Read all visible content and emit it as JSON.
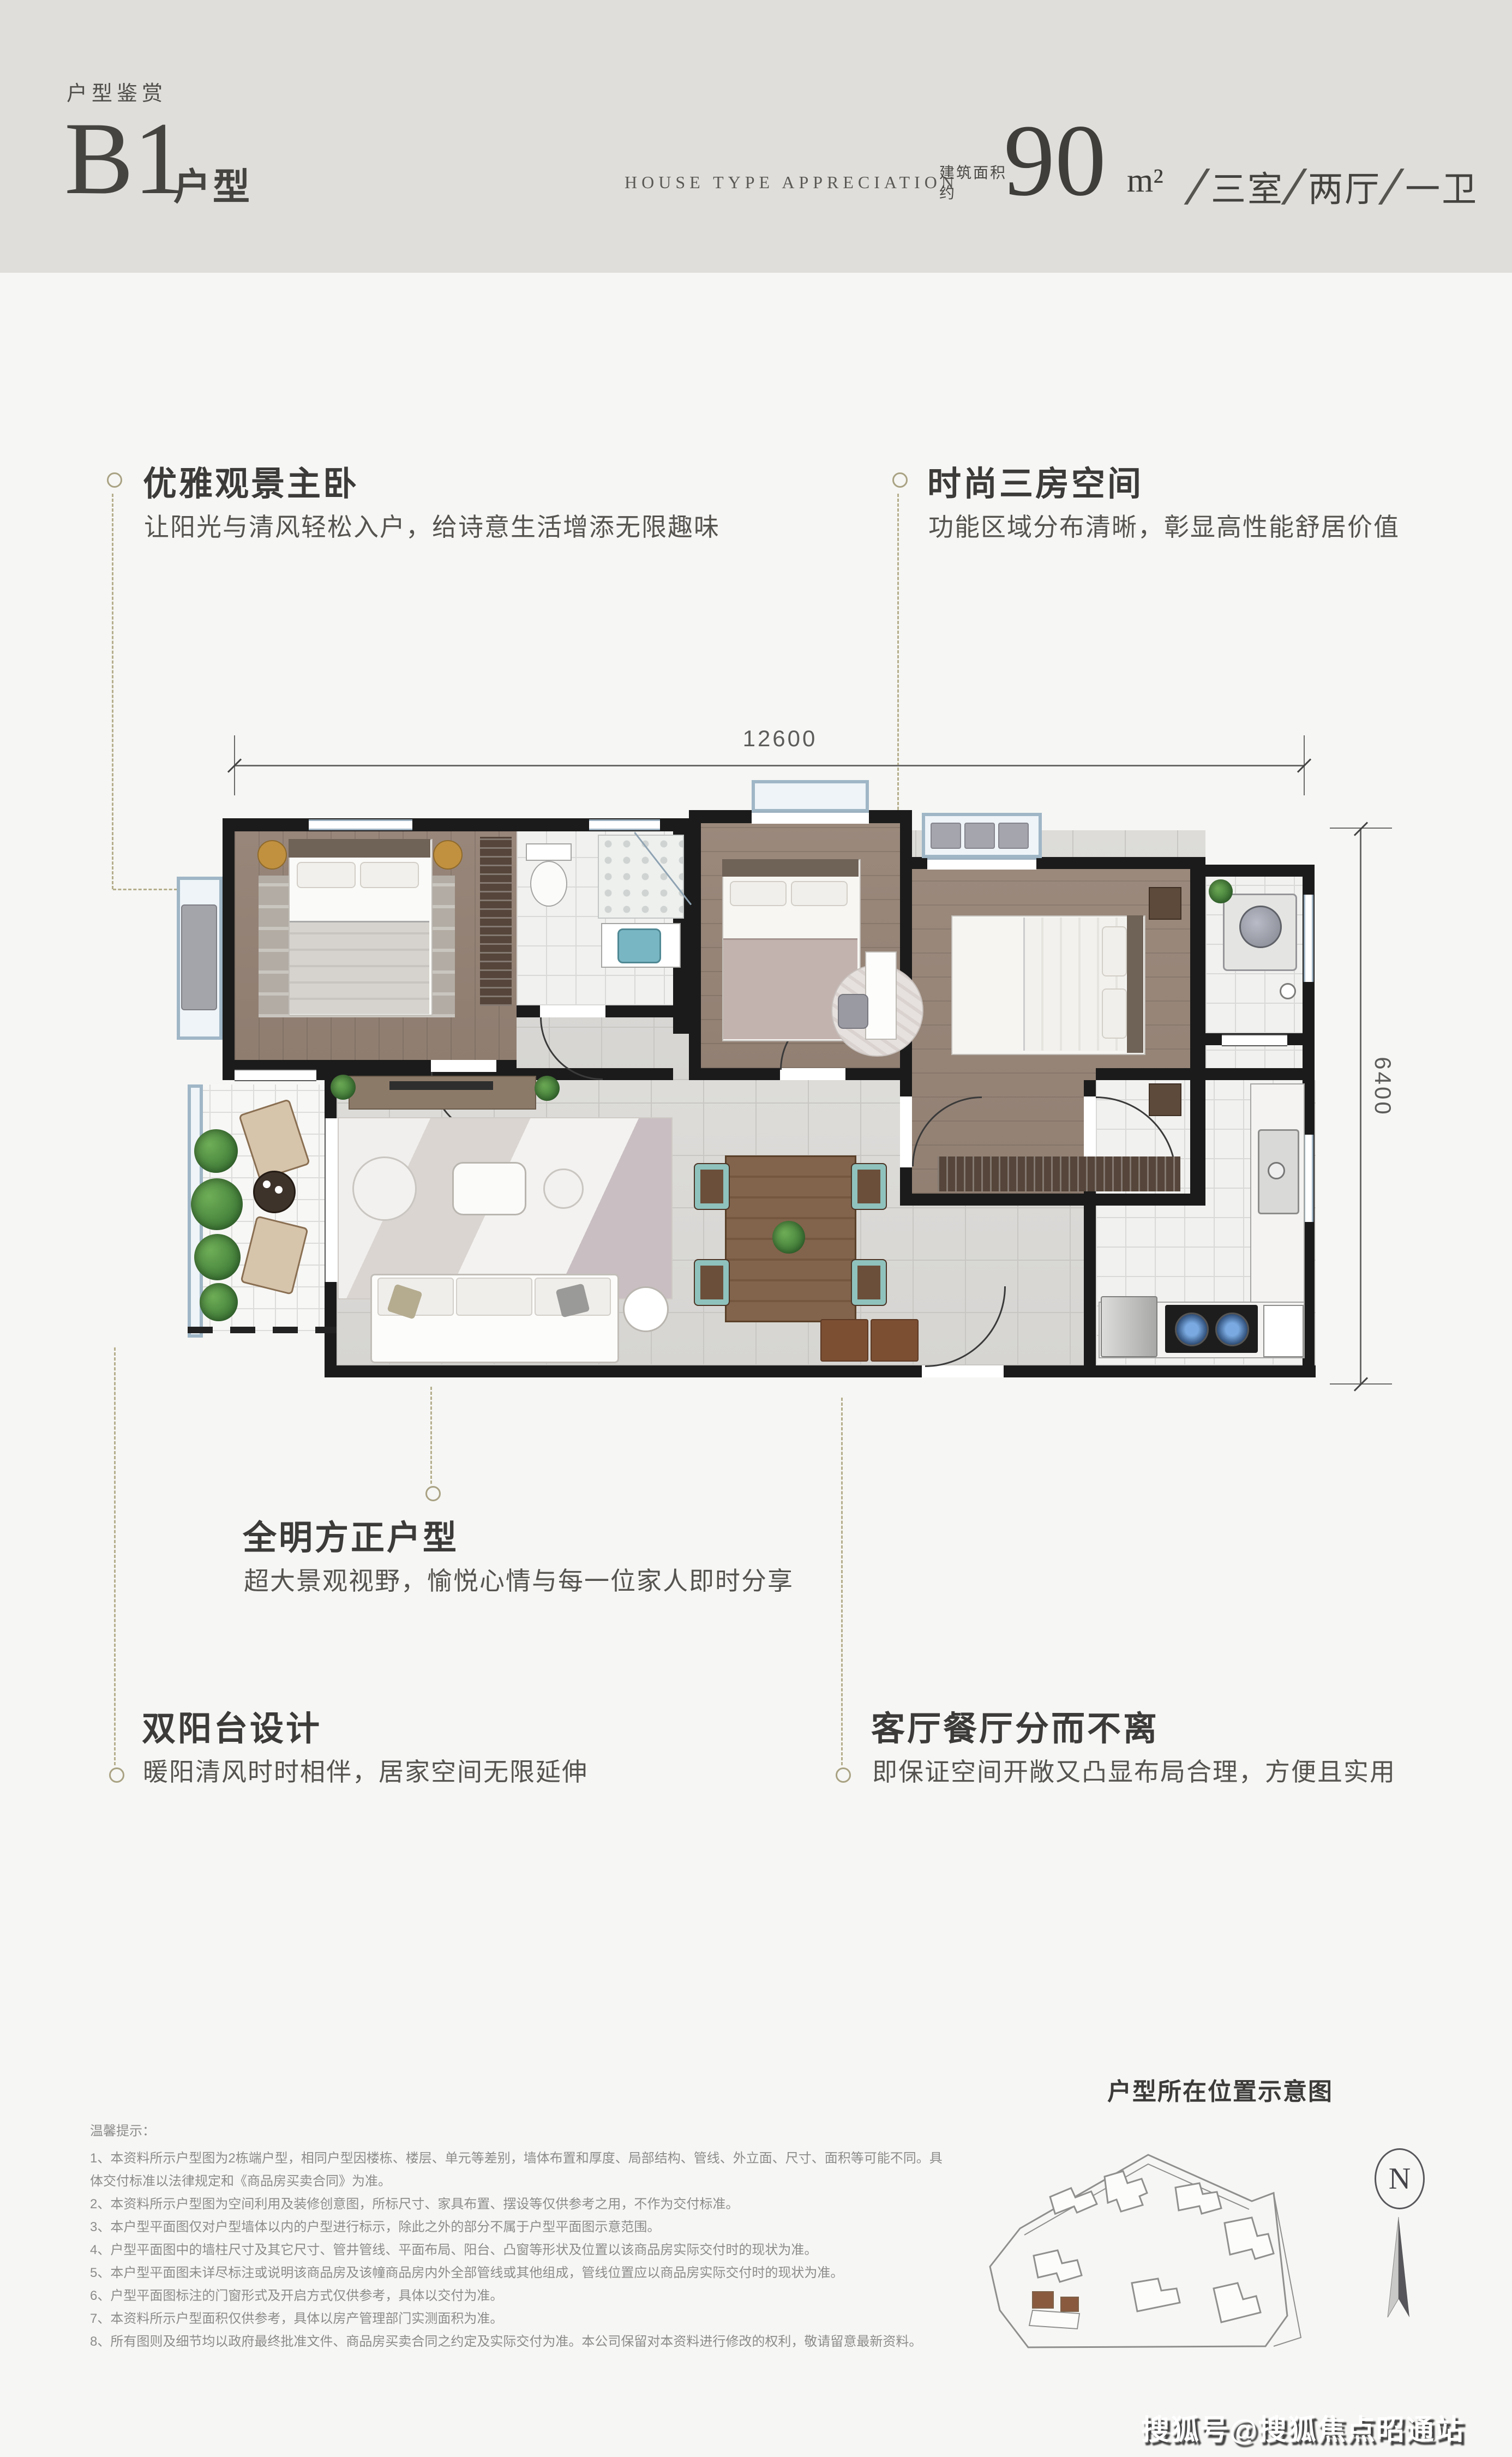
{
  "header": {
    "eyebrow": "户型鉴赏",
    "unit_code": "B1",
    "unit_suffix": "户型",
    "subtitle_en": "HOUSE TYPE APPRECIATION",
    "area_label_line1": "建筑面积",
    "area_label_line2": "约",
    "area_value": "90",
    "area_unit": "m²",
    "room_separator": "∕",
    "rooms": [
      {
        "label": "三室"
      },
      {
        "label": "两厅"
      },
      {
        "label": "一卫"
      }
    ]
  },
  "dimensions": {
    "width_label": "12600",
    "height_label": "6400"
  },
  "annotations": [
    {
      "title": "优雅观景主卧",
      "subtitle": "让阳光与清风轻松入户，给诗意生活增添无限趣味"
    },
    {
      "title": "时尚三房空间",
      "subtitle": "功能区域分布清晰，彰显高性能舒居价值"
    },
    {
      "title": "全明方正户型",
      "subtitle": "超大景观视野，愉悦心情与每一位家人即时分享"
    },
    {
      "title": "双阳台设计",
      "subtitle": "暖阳清风时时相伴，居家空间无限延伸"
    },
    {
      "title": "客厅餐厅分而不离",
      "subtitle": "即保证空间开敞又凸显布局合理，方便且实用"
    }
  ],
  "site_map": {
    "title": "户型所在位置示意图",
    "compass_label": "N"
  },
  "disclaimer": {
    "title": "温馨提示：",
    "items": [
      "1、本资料所示户型图为2栋端户型，相同户型因楼栋、楼层、单元等差别，墙体布置和厚度、局部结构、管线、外立面、尺寸、面积等可能不同。具体交付标准以法律规定和《商品房买卖合同》为准。",
      "2、本资料所示户型图为空间利用及装修创意图，所标尺寸、家具布置、摆设等仅供参考之用，不作为交付标准。",
      "3、本户型平面图仅对户型墙体以内的户型进行标示，除此之外的部分不属于户型平面图示意范围。",
      "4、户型平面图中的墙柱尺寸及其它尺寸、管井管线、平面布局、阳台、凸窗等形状及位置以该商品房实际交付时的现状为准。",
      "5、本户型平面图未详尽标注或说明该商品房及该幢商品房内外全部管线或其他组成，管线位置应以商品房实际交付时的现状为准。",
      "6、户型平面图标注的门窗形式及开启方式仅供参考，具体以交付为准。",
      "7、本资料所示户型面积仅供参考，具体以房产管理部门实测面积为准。",
      "8、所有图则及细节均以政府最终批准文件、商品房买卖合同之约定及实际交付为准。本公司保留对本资料进行修改的权利，敬请留意最新资料。"
    ]
  },
  "watermark": "搜狐号@搜狐焦点昭通站"
}
